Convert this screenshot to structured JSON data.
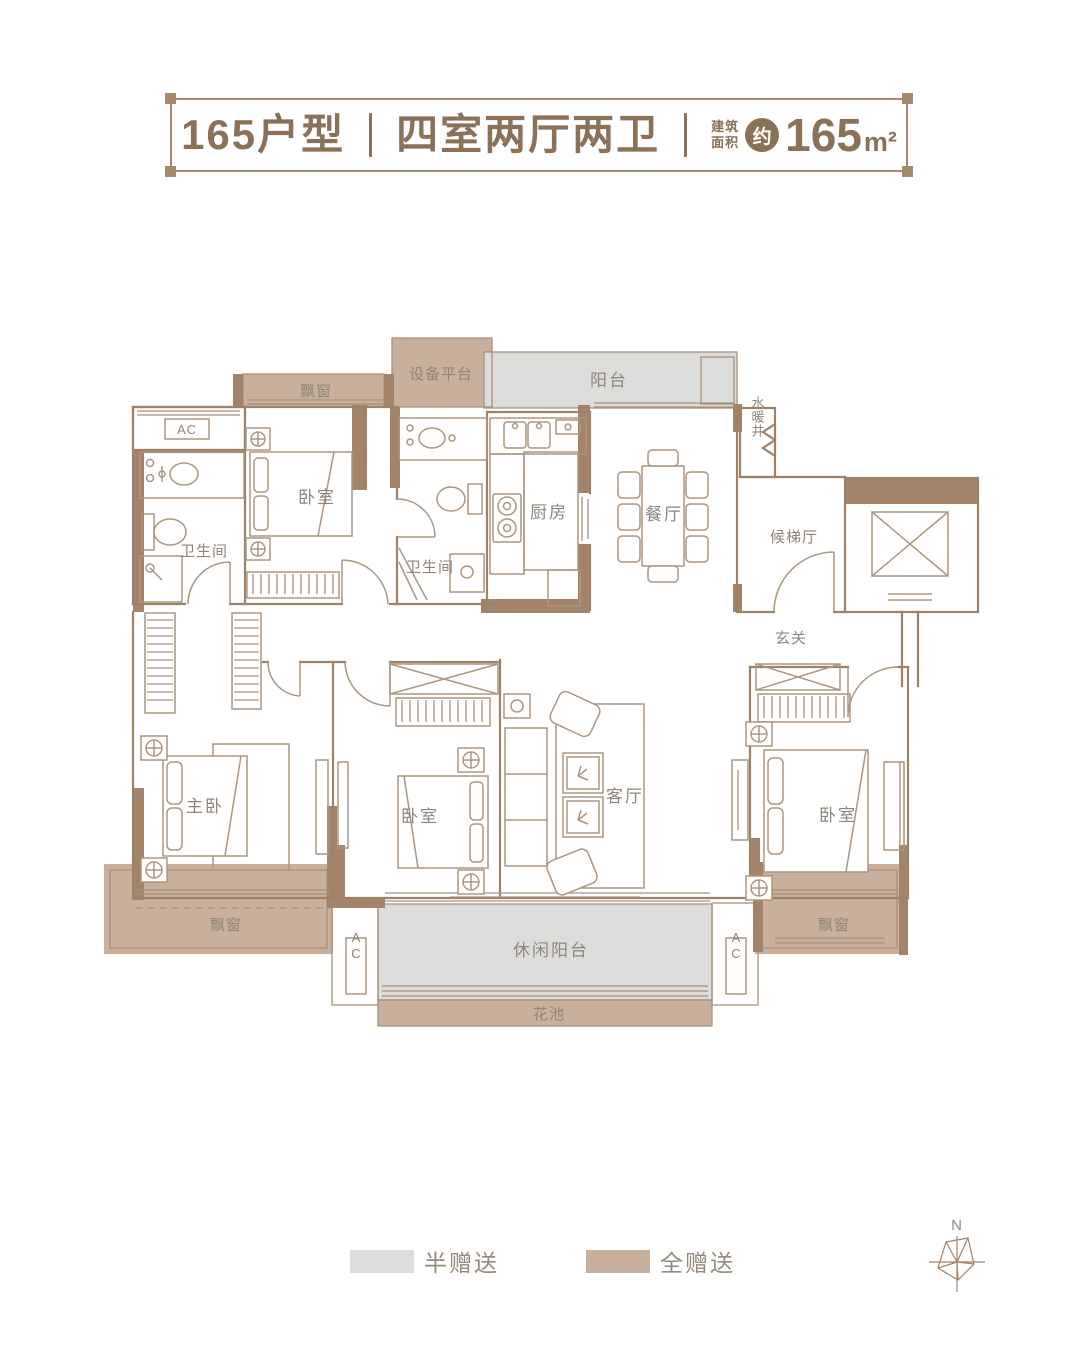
{
  "title": {
    "model": "165户型",
    "layout": "四室两厅两卫",
    "area_prefix_line1": "建筑",
    "area_prefix_line2": "面积",
    "area_approx": "约",
    "area_value": "165",
    "area_unit": "m²"
  },
  "rooms": {
    "bay_window_top_left": "飘窗",
    "equipment_platform": "设备平台",
    "balcony_top": "阳台",
    "water_heating_shaft": "水暖井",
    "ac_top_left": "AC",
    "bedroom_top_left": "卧室",
    "bathroom_left": "卫生间",
    "bathroom_middle": "卫生间",
    "kitchen": "厨房",
    "dining_room": "餐厅",
    "elevator_lobby": "候梯厅",
    "entrance_hall": "玄关",
    "master_bedroom": "主卧",
    "bedroom_middle": "卧室",
    "living_room": "客厅",
    "bedroom_right": "卧室",
    "bay_window_bottom_left": "飘窗",
    "leisure_balcony": "休闲阳台",
    "flower_bed": "花池",
    "bay_window_bottom_right": "飘窗",
    "ac_bottom_left": "AC",
    "ac_bottom_right": "AC"
  },
  "legend": {
    "half_gift": {
      "label": "半赠送",
      "color": "#dcdddb"
    },
    "full_gift": {
      "label": "全赠送",
      "color": "#c8b09d"
    }
  },
  "compass": {
    "north_label": "N"
  },
  "colors": {
    "wall": "#a3846a",
    "outline": "#9d8266",
    "furniture_line": "#ad967f",
    "gray_fill": "#dcdddb",
    "tan_fill": "#c8b09d",
    "label_text": "#8f857a",
    "title_text": "#8a7157"
  }
}
